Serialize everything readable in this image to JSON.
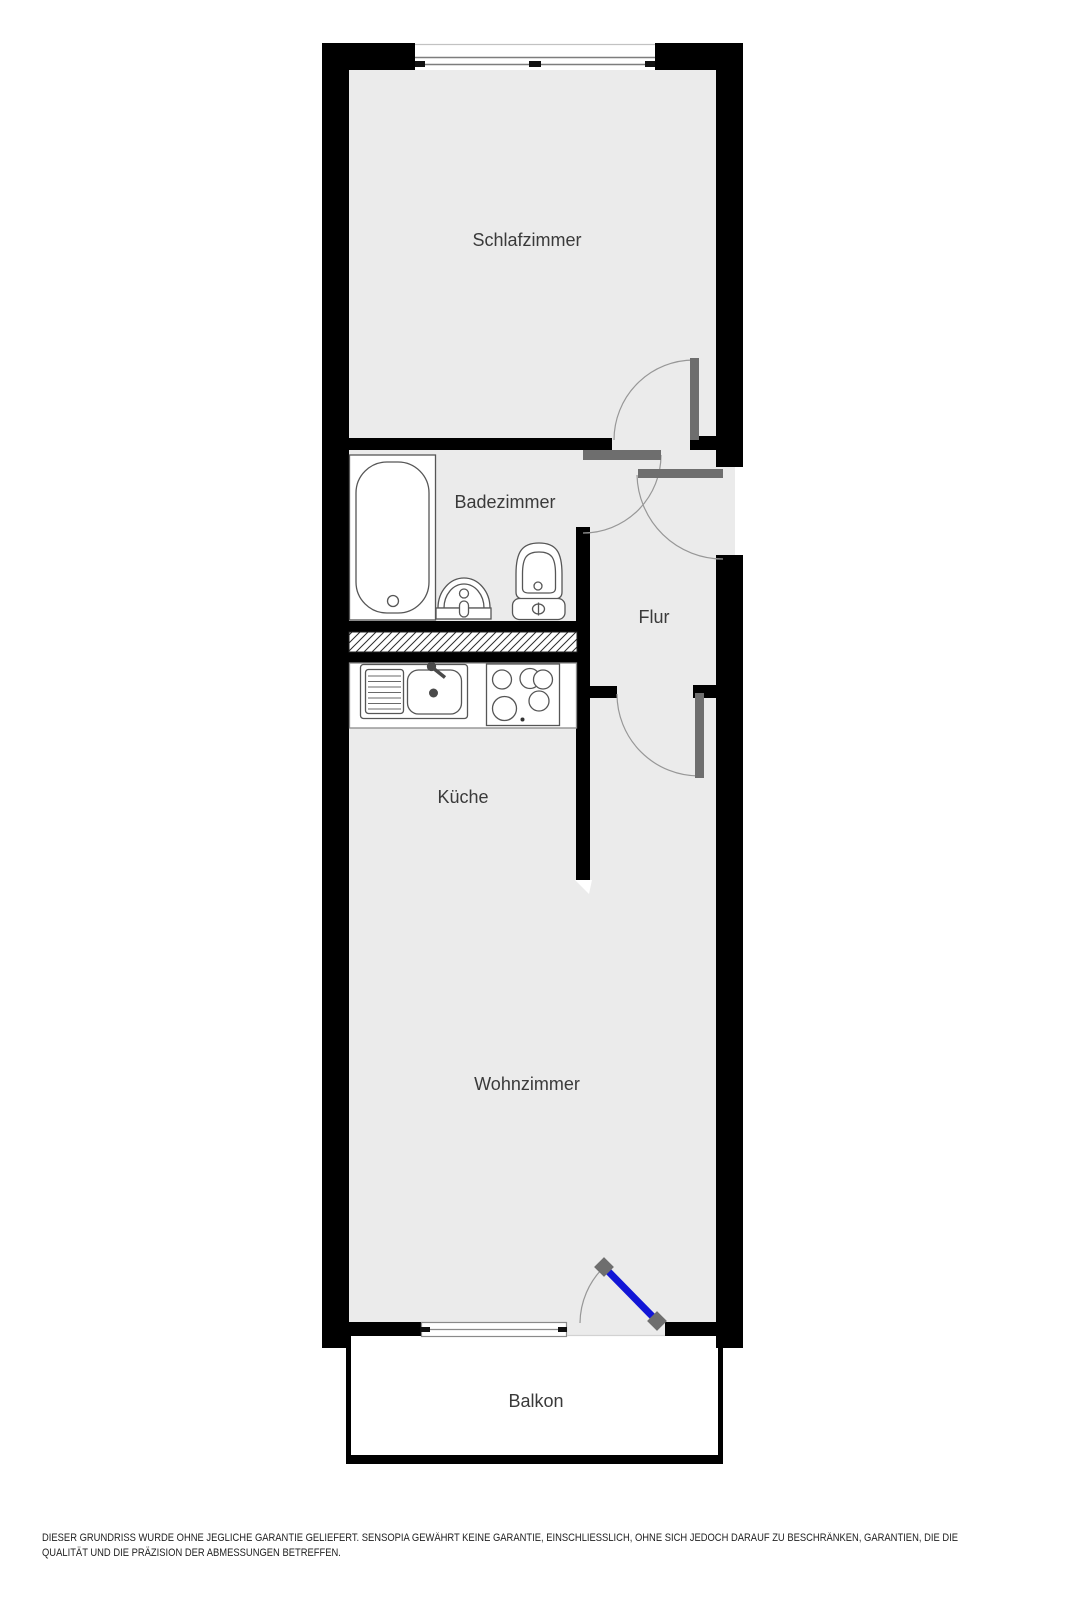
{
  "floorplan": {
    "rooms": {
      "schlafzimmer": "Schlafzimmer",
      "badezimmer": "Badezimmer",
      "flur": "Flur",
      "kueche": "Küche",
      "wohnzimmer": "Wohnzimmer",
      "balkon": "Balkon"
    },
    "colors": {
      "wall": "#000000",
      "floor": "#ebebeb",
      "door_leaf": "#6e6e6e",
      "door_arc": "#979797",
      "balcony_door_blue": "#1216d6",
      "fixture_outline": "#565656",
      "label_text": "#3a3a3a",
      "balcony_fill": "#ffffff"
    },
    "disclaimer": {
      "line1": "DIESER GRUNDRISS WURDE OHNE JEGLICHE GARANTIE GELIEFERT. SENSOPIA GEWÄHRT KEINE GARANTIE, EINSCHLIESSLICH, OHNE SICH JEDOCH DARAUF ZU BESCHRÄNKEN, GARANTIEN, DIE DIE",
      "line2": "QUALITÄT UND DIE PRÄZISION DER ABMESSUNGEN BETREFFEN."
    }
  }
}
